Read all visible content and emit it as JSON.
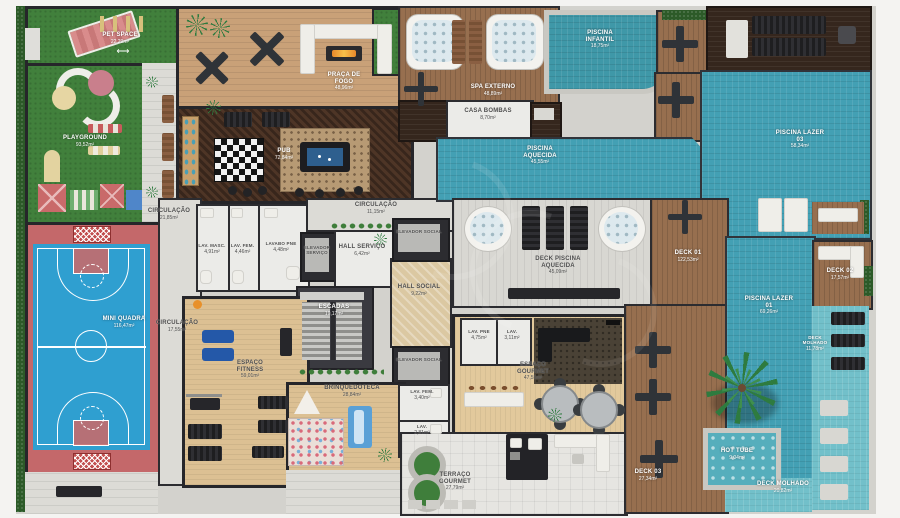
{
  "colors": {
    "water_teal": "#43a0b4",
    "wet_deck_teal": "#72c0ca",
    "grass_green": "#41803c",
    "court_blue": "#2f9fd0",
    "court_pink": "#c4686a",
    "wood_light": "#c9a178",
    "wood_deck": "#976f4f",
    "wood_dark": "#35261d",
    "interior_wood": "#dcc093",
    "wall": "#26262a"
  },
  "rooms": {
    "pet_space": {
      "label": "PET SPACE",
      "area": "22,29m²"
    },
    "playground": {
      "label": "PLAYGROUND",
      "area": "93,52m²"
    },
    "mini_quadra": {
      "label": "MINI QUADRA",
      "area": "116,47m²"
    },
    "praca_de_fogo": {
      "label": "PRAÇA DE FOGO",
      "area": "48,96m²"
    },
    "pub": {
      "label": "PUB",
      "area": "72,84m²"
    },
    "circulacao_pub": {
      "label": "CIRCULAÇÃO",
      "area": "21,85m²"
    },
    "lav_masc": {
      "label": "LAV. MASC.",
      "area": "4,91m²"
    },
    "lav_fem": {
      "label": "LAV. FEM.",
      "area": "4,46m²"
    },
    "lavabo_pne": {
      "label": "LAVABO PNE",
      "area": "4,48m²"
    },
    "circulacao_top": {
      "label": "CIRCULAÇÃO",
      "area": "11,15m²"
    },
    "elevador_servico": {
      "label": "ELEVADOR SERVIÇO"
    },
    "hall_servico": {
      "label": "HALL SERVIÇO",
      "area": "6,42m²"
    },
    "escadas": {
      "label": "ESCADAS",
      "area": "19,17m²"
    },
    "hall_social": {
      "label": "HALL SOCIAL",
      "area": "9,22m²"
    },
    "elevador_social_top": {
      "label": "ELEVADOR SOCIAL"
    },
    "elevador_social_bottom": {
      "label": "ELEVADOR SOCIAL"
    },
    "circulacao_fitness": {
      "label": "CIRCULAÇÃO",
      "area": "17,55m²"
    },
    "espaco_fitness": {
      "label": "ESPAÇO FITNESS",
      "area": "59,01m²"
    },
    "brinquedoteca": {
      "label": "BRINQUEDOTECA",
      "area": "28,84m²"
    },
    "lav_fem_2": {
      "label": "LAV. FEM.",
      "area": "3,40m²"
    },
    "lav_2": {
      "label": "LAV.",
      "area": "2,81m²"
    },
    "lav_pne": {
      "label": "LAV. PNE",
      "area": "4,75m²"
    },
    "lav_3": {
      "label": "LAV.",
      "area": "3,11m²"
    },
    "espaco_gourmet": {
      "label": "ESPAÇO GOURMET",
      "area": "47,55m²"
    },
    "terraco_gourmet": {
      "label": "TERRAÇO GOURMET",
      "area": "27,79m²"
    },
    "spa_externo": {
      "label": "SPA EXTERNO",
      "area": "48,89m²"
    },
    "casa_bombas": {
      "label": "CASA BOMBAS",
      "area": "8,70m²"
    },
    "piscina_infantil": {
      "label": "PISCINA INFANTIL",
      "area": "18,75m²"
    },
    "piscina_aquecida": {
      "label": "PISCINA AQUECIDA",
      "area": "45,55m²"
    },
    "deck_piscina_aquecida": {
      "label": "DECK PISCINA AQUECIDA",
      "area": "45,09m²"
    },
    "deck_01": {
      "label": "DECK 01",
      "area": "122,53m²"
    },
    "piscina_lazer_03": {
      "label": "PISCINA LAZER 03",
      "area": "58,34m²"
    },
    "deck_02": {
      "label": "DECK 02",
      "area": "17,57m²"
    },
    "piscina_lazer_01": {
      "label": "PISCINA LAZER 01",
      "area": "69,26m²"
    },
    "deck_molhado_right": {
      "label": "DECK MOLHADO",
      "area": "11,78m²"
    },
    "hot_tube": {
      "label": "HOT TUBE",
      "area": "9,04m²"
    },
    "deck_03": {
      "label": "DECK 03",
      "area": "27,34m²"
    },
    "deck_molhado_bottom": {
      "label": "DECK MOLHADO",
      "area": "20,82m²"
    }
  }
}
